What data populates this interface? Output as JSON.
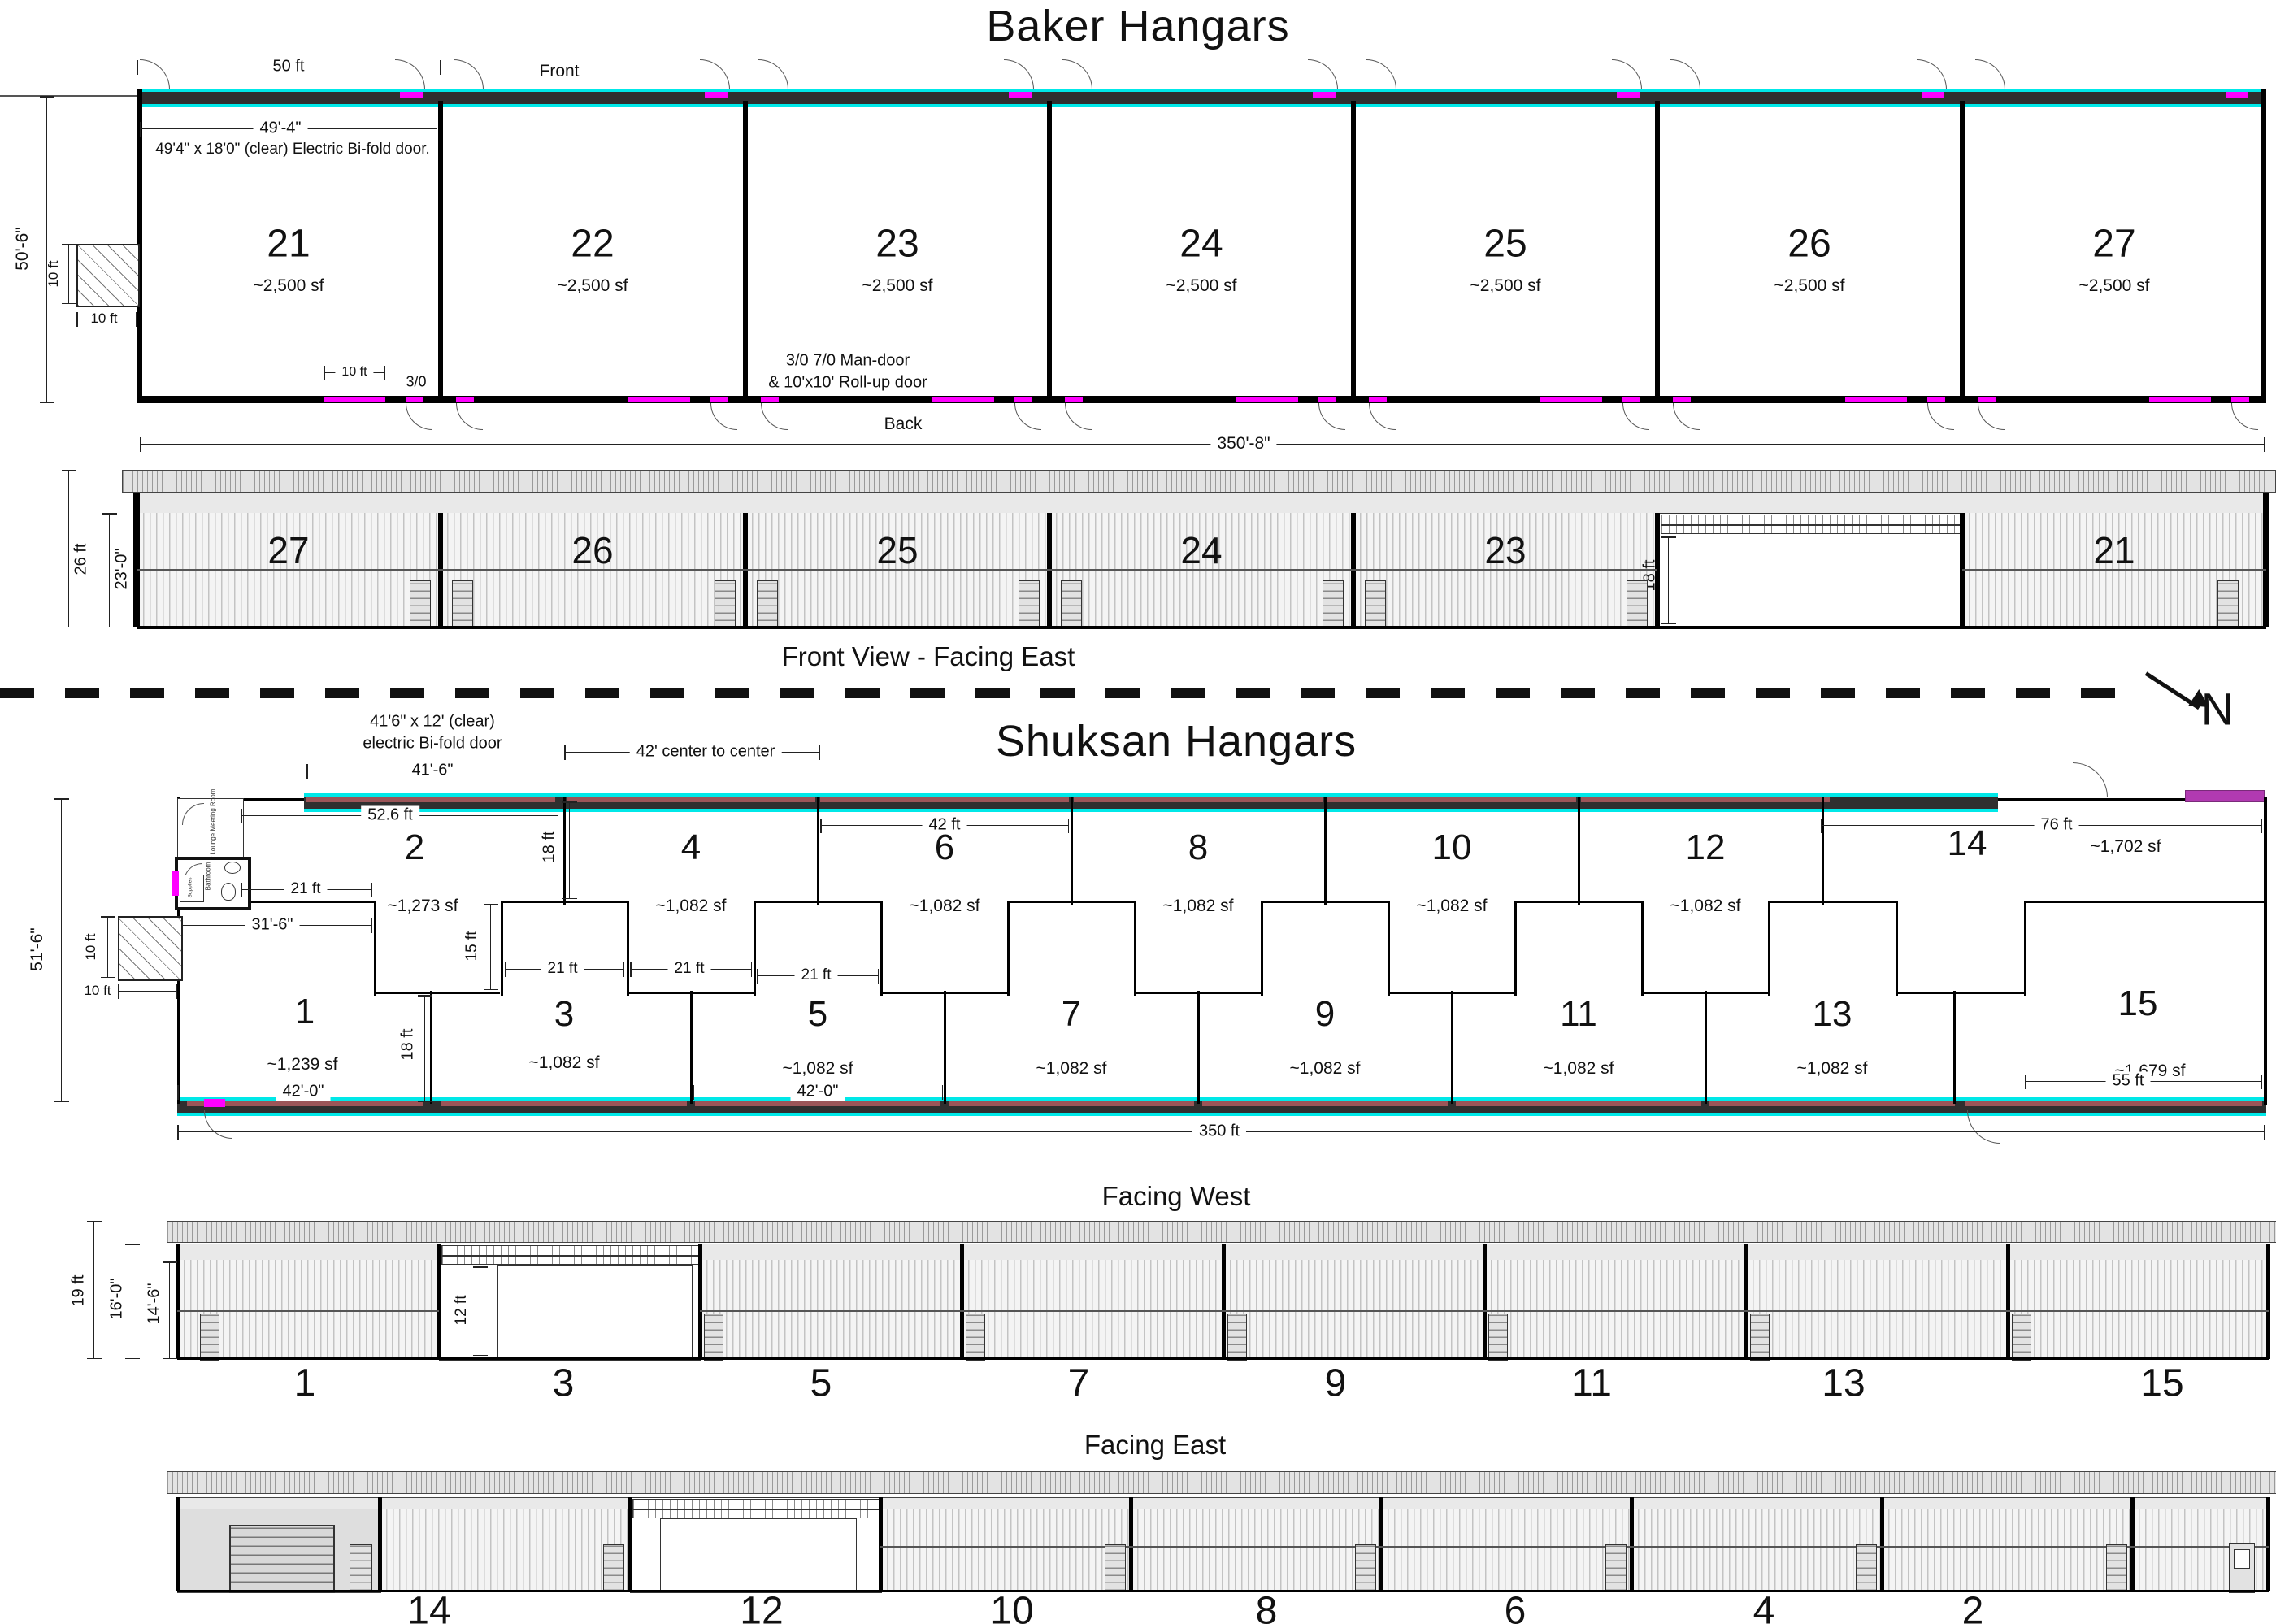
{
  "colors": {
    "accent_cyan": "#00e8e8",
    "accent_magenta": "#ff00ff",
    "accent_purple": "#b13ab1",
    "door_red": "#9b5558"
  },
  "north_label": "N",
  "baker": {
    "title": "Baker Hangars",
    "front_label": "Front",
    "back_label": "Back",
    "dims": {
      "unit_width": "50 ft",
      "door_width": "49'-4\"",
      "door_note": "49'4\" x 18'0\" (clear) Electric Bi-fold door.",
      "depth": "50'-6\"",
      "ten": "10 ft",
      "man_door_size": "3/0",
      "man_door_note_1": "3/0  7/0 Man-door",
      "man_door_note_2": "& 10'x10' Roll-up door",
      "total_length": "350'-8\""
    },
    "units": [
      {
        "n": "21",
        "a": "~2,500 sf"
      },
      {
        "n": "22",
        "a": "~2,500 sf"
      },
      {
        "n": "23",
        "a": "~2,500 sf"
      },
      {
        "n": "24",
        "a": "~2,500 sf"
      },
      {
        "n": "25",
        "a": "~2,500 sf"
      },
      {
        "n": "26",
        "a": "~2,500 sf"
      },
      {
        "n": "27",
        "a": "~2,500 sf"
      }
    ],
    "elev": {
      "title": "Front View - Facing East",
      "height_total": "26 ft",
      "height_eave": "23'-0\"",
      "door_h": "18 ft",
      "bays": [
        "27",
        "26",
        "25",
        "24",
        "23",
        "21"
      ]
    }
  },
  "shuksan": {
    "title": "Shuksan Hangars",
    "dims": {
      "bifold_1": "41'6\" x 12' (clear)",
      "bifold_2": "electric Bi-fold door",
      "door_width": "41'-6\"",
      "c2c": "42' center to center",
      "w526": "52.6 ft",
      "d18": "18 ft",
      "d21": "21 ft",
      "w316": "31'-6\"",
      "d15": "15 ft",
      "w42": "42 ft",
      "w420": "42'-0\"",
      "total_length": "350 ft",
      "w55": "55 ft",
      "w76": "76 ft",
      "depth": "51'-6\"",
      "ten": "10 ft"
    },
    "rooms": {
      "lounge": "Pilot Lounge Meeting Room",
      "bath": "Bathroom",
      "supplies": "Supplies"
    },
    "units": [
      {
        "n": "1",
        "a": "~1,239 sf"
      },
      {
        "n": "2",
        "a": "~1,273 sf"
      },
      {
        "n": "3",
        "a": "~1,082 sf"
      },
      {
        "n": "4",
        "a": "~1,082 sf"
      },
      {
        "n": "5",
        "a": "~1,082 sf"
      },
      {
        "n": "6",
        "a": "~1,082 sf"
      },
      {
        "n": "7",
        "a": "~1,082 sf"
      },
      {
        "n": "8",
        "a": "~1,082 sf"
      },
      {
        "n": "9",
        "a": "~1,082 sf"
      },
      {
        "n": "10",
        "a": "~1,082 sf"
      },
      {
        "n": "11",
        "a": "~1,082 sf"
      },
      {
        "n": "12",
        "a": "~1,082 sf"
      },
      {
        "n": "13",
        "a": "~1,082 sf"
      },
      {
        "n": "14",
        "a": "~1,702 sf"
      },
      {
        "n": "15",
        "a": "~1,679 sf"
      }
    ],
    "west": {
      "title": "Facing West",
      "h1": "19 ft",
      "h2": "16'-0\"",
      "h3": "14'-6\"",
      "door_h": "12 ft",
      "bays": [
        "1",
        "3",
        "5",
        "7",
        "9",
        "11",
        "13",
        "15"
      ]
    },
    "east": {
      "title": "Facing East",
      "bays": [
        "14",
        "12",
        "10",
        "8",
        "6",
        "4",
        "2"
      ]
    }
  }
}
